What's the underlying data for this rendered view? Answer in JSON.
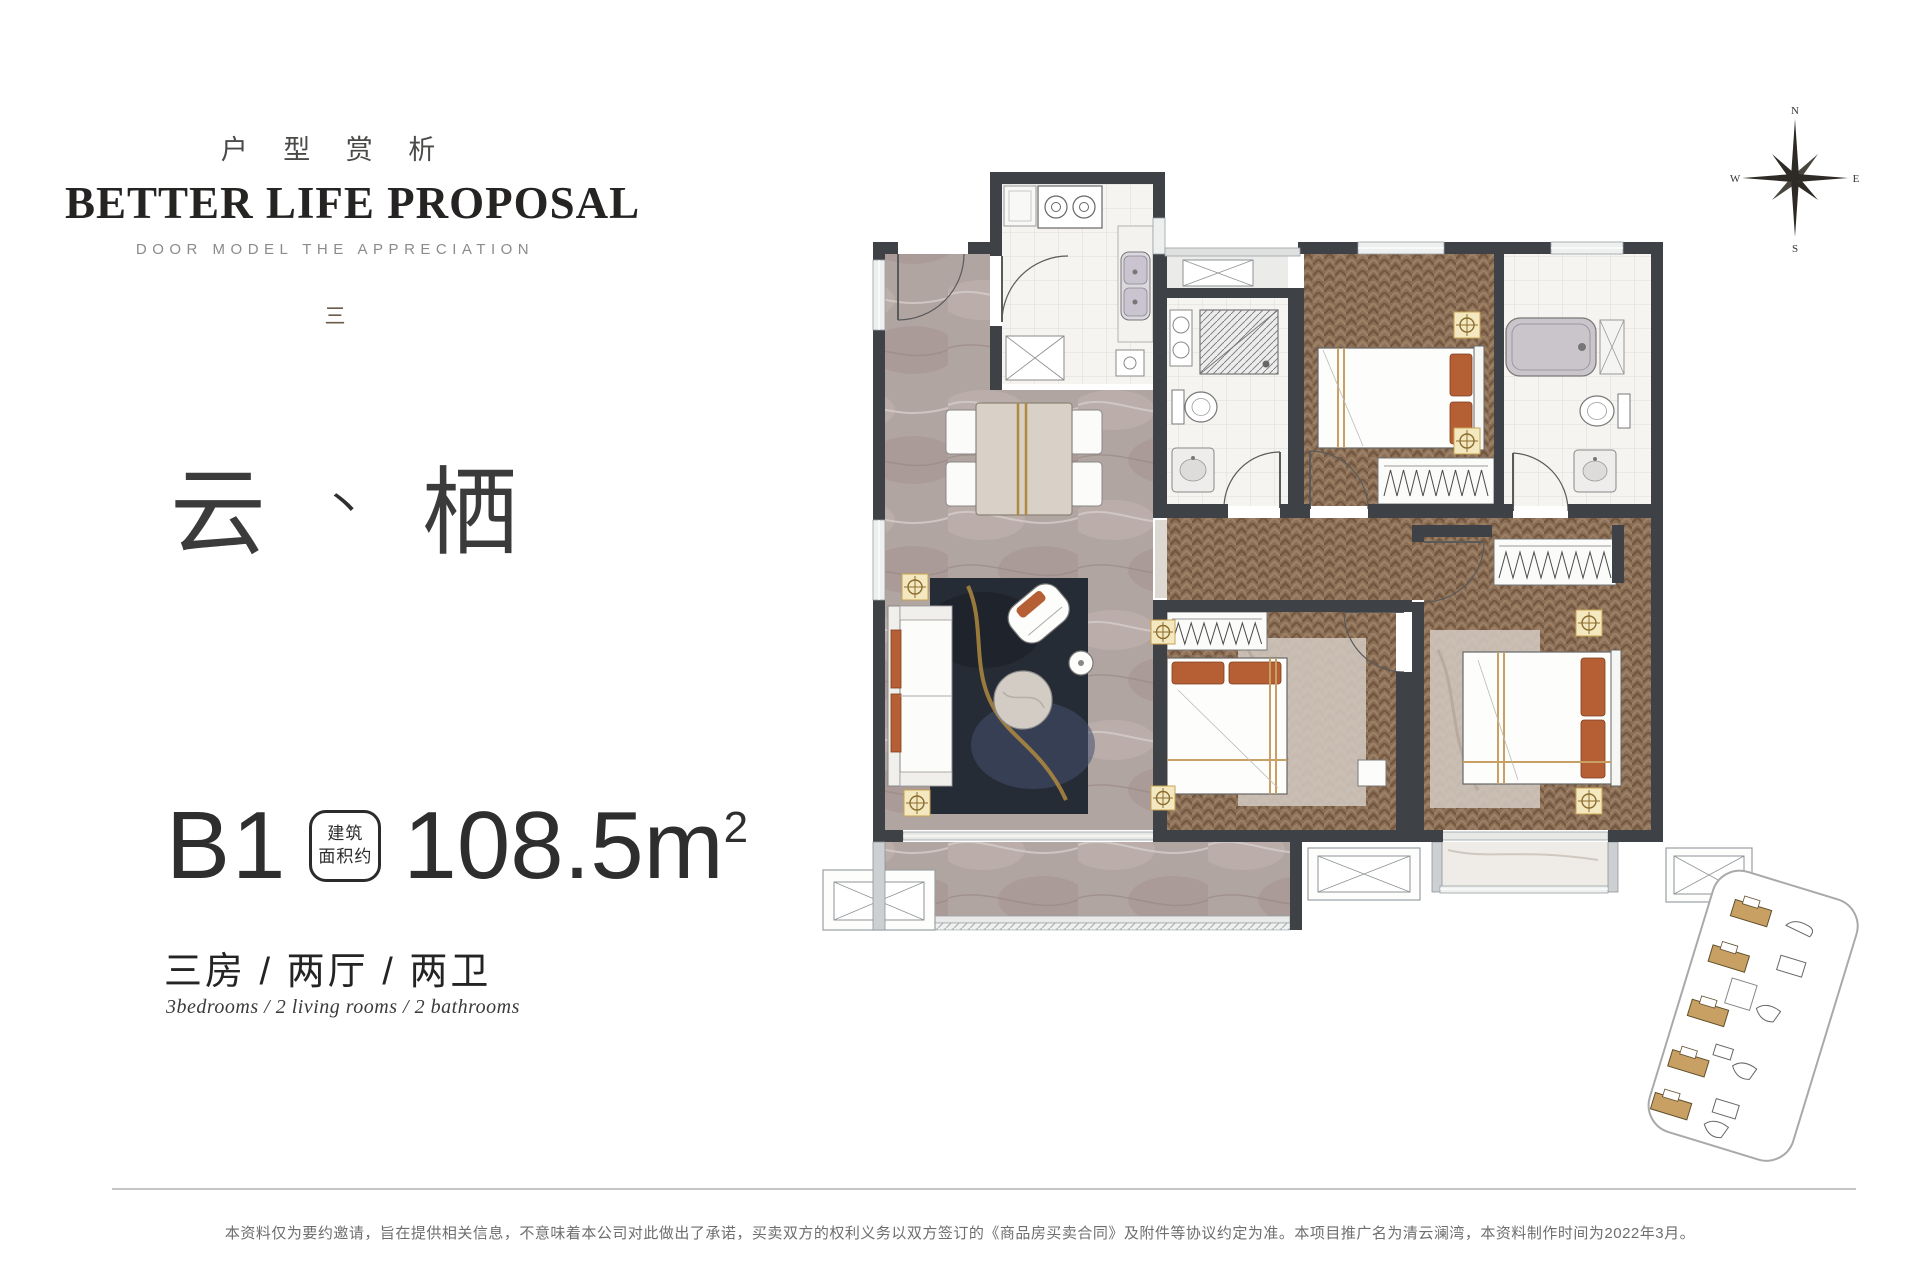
{
  "header": {
    "cn_title": "户 型 赏 析",
    "en_title": "BETTER LIFE PROPOSAL",
    "subtitle": "DOOR MODEL THE APPRECIATION",
    "ornament": "三"
  },
  "unit_name": {
    "first": "云",
    "separator": "丶",
    "second": "栖"
  },
  "spec": {
    "plan_code": "B1",
    "badge_line1": "建筑",
    "badge_line2": "面积约",
    "area_value": "108.5",
    "area_unit": "m",
    "area_sup": "2",
    "rooms_cn": "三房 / 两厅 / 两卫",
    "rooms_en": "3bedrooms / 2 living rooms / 2 bathrooms"
  },
  "compass": {
    "north": "N",
    "east": "E",
    "south": "S",
    "west": "W"
  },
  "footer": {
    "disclaimer": "本资料仅为要约邀请，旨在提供相关信息，不意味着本公司对此做出了承诺，买卖双方的权利义务以双方签订的《商品房买卖合同》及附件等协议约定为准。本项目推广名为清云澜湾，本资料制作时间为2022年3月。"
  },
  "colors": {
    "wall": "#3e4146",
    "wood_floor": "#8b6f56",
    "marble_floor": "#b1a5a2",
    "accent_orange": "#b65f35",
    "accent_gold": "#c9a063",
    "text_dark": "#2b2b2b",
    "text_gray": "#8b8b8b"
  }
}
